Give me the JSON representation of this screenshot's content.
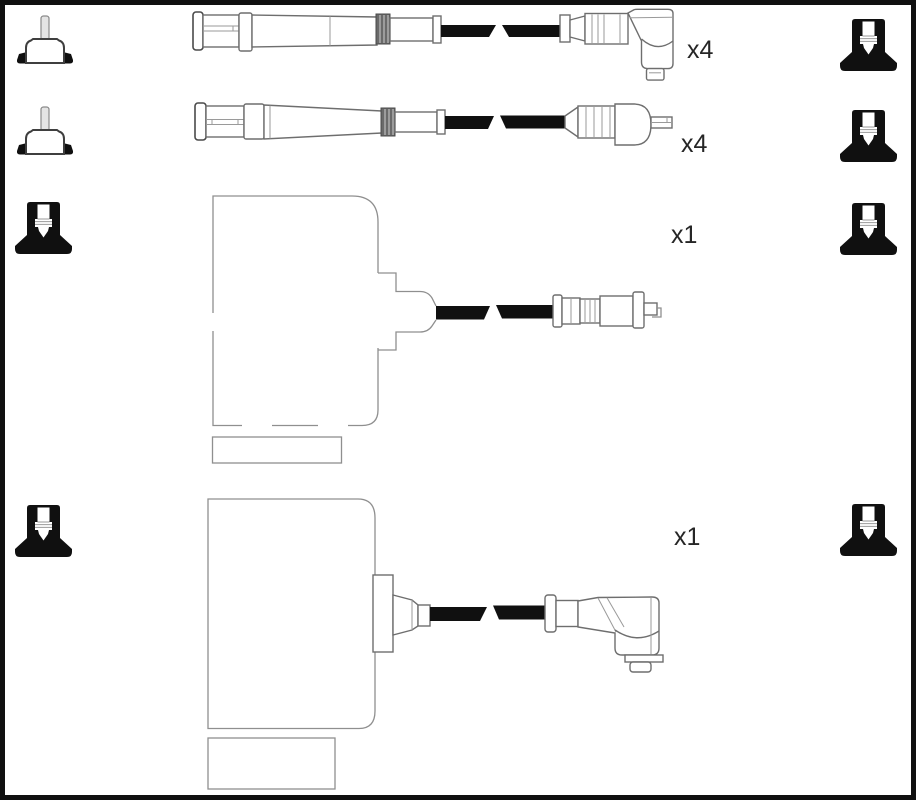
{
  "canvas": {
    "width": 916,
    "height": 800
  },
  "colors": {
    "background": "#ffffff",
    "border": "#101010",
    "line": "#6e6e6e",
    "light_line": "#8f8f8f",
    "black_fill": "#101010",
    "ribbed_ring": "#6a6a6a",
    "label_text": "#262626"
  },
  "quantity_labels": [
    {
      "text": "x4"
    },
    {
      "text": "x4"
    },
    {
      "text": "x1"
    },
    {
      "text": "x1"
    }
  ],
  "icons": {
    "left": [
      {
        "name": "coil-terminal-icon"
      },
      {
        "name": "coil-terminal-icon"
      },
      {
        "name": "spark-plug-boot-icon"
      },
      {
        "name": "spark-plug-boot-icon"
      }
    ],
    "right": [
      {
        "name": "spark-plug-boot-icon"
      },
      {
        "name": "spark-plug-boot-icon"
      },
      {
        "name": "spark-plug-boot-icon"
      },
      {
        "name": "spark-plug-boot-icon"
      }
    ]
  }
}
